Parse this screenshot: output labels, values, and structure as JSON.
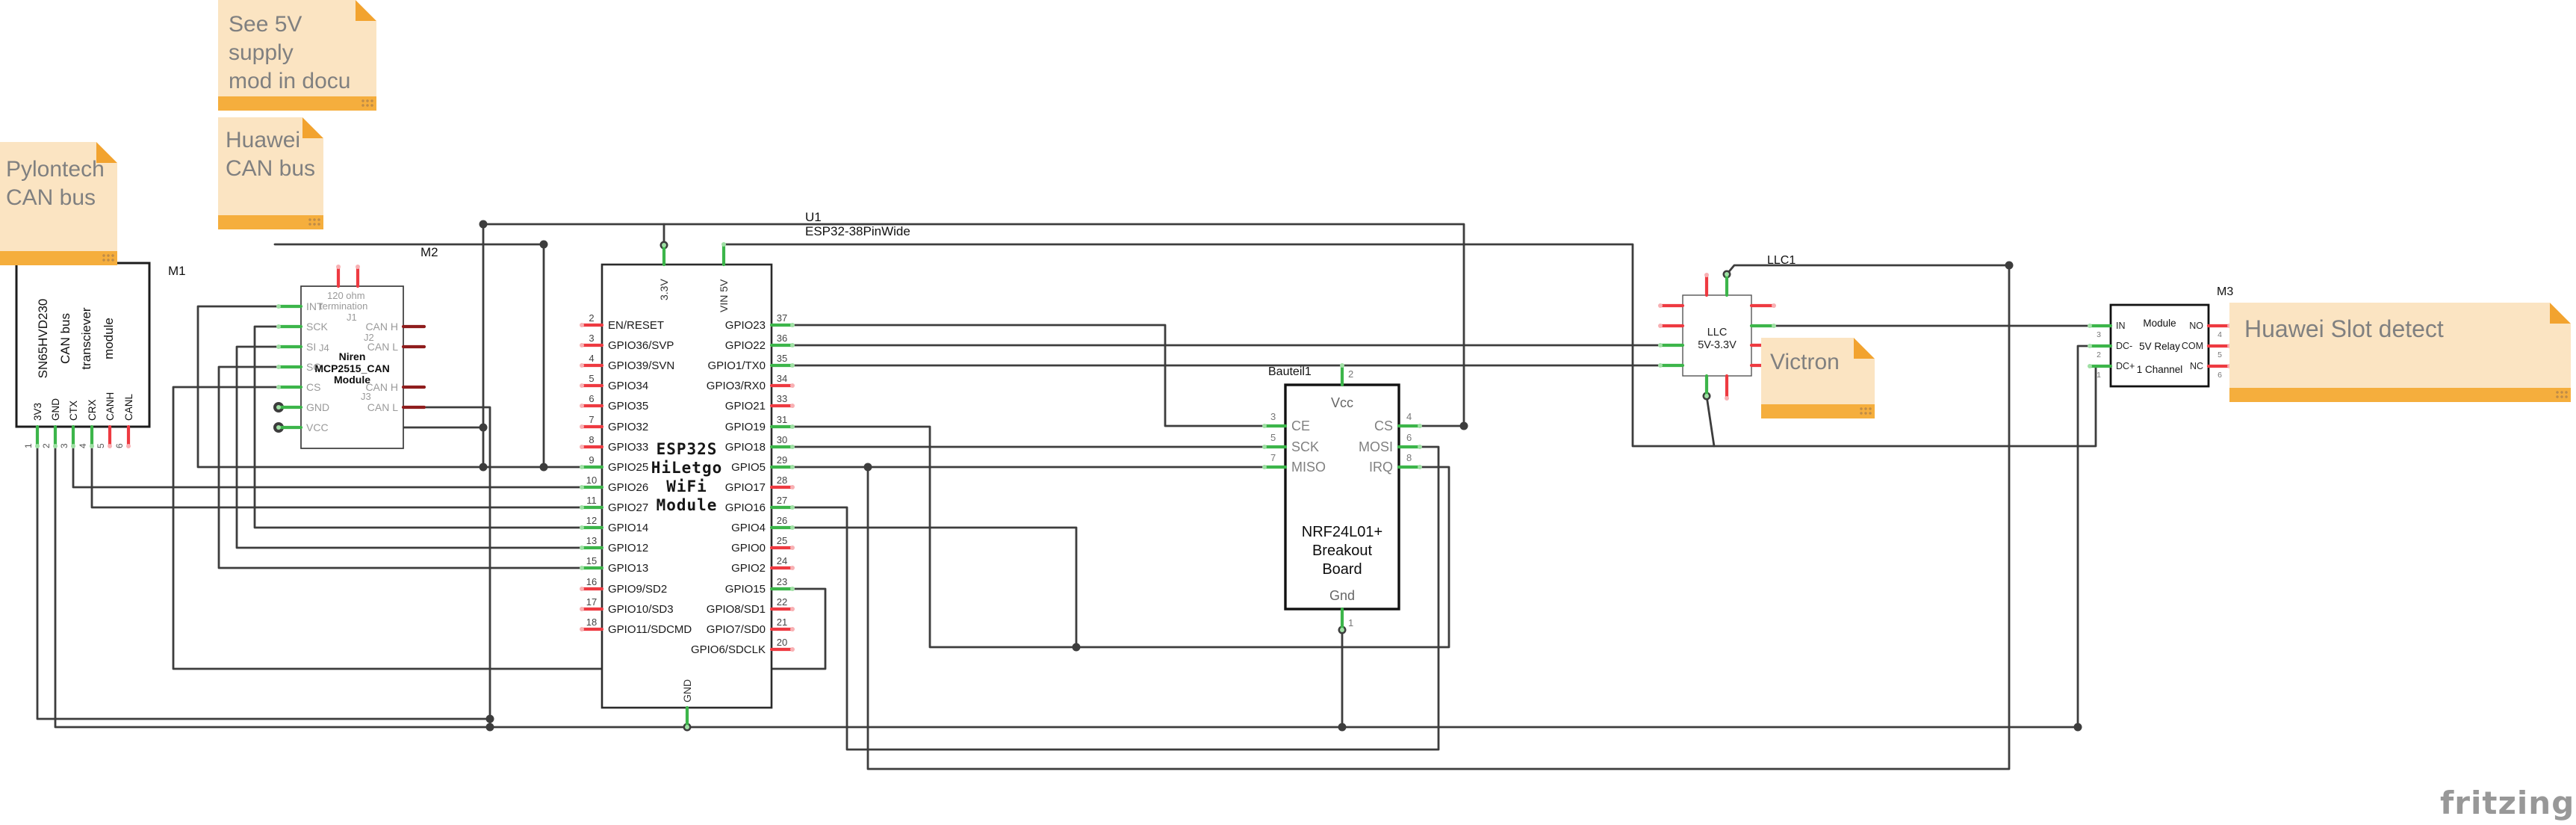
{
  "app": {
    "watermark": "fritzing"
  },
  "colors": {
    "wire": "#3d3d3d",
    "pin_green": "#3cb54a",
    "pin_green_cap": "#9fe0a4",
    "pin_red": "#ee3a41",
    "pin_red_cap": "#f8b0b3",
    "pin_darkred": "#8f1d1d",
    "note_bg": "#fbe4c2",
    "note_bar": "#f5ae3d",
    "note_text": "#808080"
  },
  "notes": {
    "supply": "See 5V supply\nmod in docu",
    "huawei_can": "Huawei\nCAN bus",
    "pylontech": "Pylontech\nCAN bus",
    "victron": "Victron",
    "slot": "Huawei Slot detect"
  },
  "components": {
    "m1": {
      "designator": "M1",
      "title_lines": [
        "SN65HVD230",
        "CAN bus",
        "transciever",
        "module"
      ],
      "pins": [
        {
          "num": "1",
          "label": "3V3",
          "color": "green"
        },
        {
          "num": "2",
          "label": "GND",
          "color": "green"
        },
        {
          "num": "3",
          "label": "CTX",
          "color": "green"
        },
        {
          "num": "4",
          "label": "CRX",
          "color": "green"
        },
        {
          "num": "5",
          "label": "CANH",
          "color": "red"
        },
        {
          "num": "6",
          "label": "CANL",
          "color": "red"
        }
      ]
    },
    "m2": {
      "designator": "M2",
      "inner": {
        "line1": "120 ohm",
        "line2": "termination",
        "j1": "J1",
        "j2": "J2",
        "j3": "J3",
        "j4": "J4",
        "name": "Niren\nMCP2515_CAN\nModule"
      },
      "left_pins": [
        {
          "label": "INT",
          "color": "green"
        },
        {
          "label": "SCK",
          "color": "green"
        },
        {
          "label": "SI",
          "color": "green"
        },
        {
          "label": "SO",
          "color": "green"
        },
        {
          "label": "CS",
          "color": "green"
        },
        {
          "label": "GND",
          "color": "green"
        },
        {
          "label": "VCC",
          "color": "green"
        }
      ],
      "right_pins": [
        {
          "label": "CAN H",
          "color": "darkred"
        },
        {
          "label": "CAN L",
          "color": "darkred"
        },
        {
          "label": "CAN H",
          "color": "darkred"
        },
        {
          "label": "CAN L",
          "color": "darkred"
        }
      ]
    },
    "u1": {
      "designator": "U1",
      "part": "ESP32-38PinWide",
      "title": "ESP32S\nHiLetgo\nWiFi\nModule",
      "top_pins": [
        {
          "label": "3.3V",
          "color": "green"
        },
        {
          "label": "VIN 5V",
          "color": "green"
        }
      ],
      "bottom_pins": [
        {
          "label": "GND",
          "color": "green"
        }
      ],
      "left_pins": [
        {
          "num": "2",
          "label": "EN/RESET",
          "color": "red"
        },
        {
          "num": "3",
          "label": "GPIO36/SVP",
          "color": "red"
        },
        {
          "num": "4",
          "label": "GPIO39/SVN",
          "color": "red"
        },
        {
          "num": "5",
          "label": "GPIO34",
          "color": "red"
        },
        {
          "num": "6",
          "label": "GPIO35",
          "color": "red"
        },
        {
          "num": "7",
          "label": "GPIO32",
          "color": "red"
        },
        {
          "num": "8",
          "label": "GPIO33",
          "color": "red"
        },
        {
          "num": "9",
          "label": "GPIO25",
          "color": "green"
        },
        {
          "num": "10",
          "label": "GPIO26",
          "color": "green"
        },
        {
          "num": "11",
          "label": "GPIO27",
          "color": "green"
        },
        {
          "num": "12",
          "label": "GPIO14",
          "color": "green"
        },
        {
          "num": "13",
          "label": "GPIO12",
          "color": "green"
        },
        {
          "num": "15",
          "label": "GPIO13",
          "color": "green"
        },
        {
          "num": "16",
          "label": "GPIO9/SD2",
          "color": "red"
        },
        {
          "num": "17",
          "label": "GPIO10/SD3",
          "color": "red"
        },
        {
          "num": "18",
          "label": "GPIO11/SDCMD",
          "color": "red"
        }
      ],
      "right_pins": [
        {
          "num": "37",
          "label": "GPIO23",
          "color": "green"
        },
        {
          "num": "36",
          "label": "GPIO22",
          "color": "green"
        },
        {
          "num": "35",
          "label": "GPIO1/TX0",
          "color": "green"
        },
        {
          "num": "34",
          "label": "GPIO3/RX0",
          "color": "red"
        },
        {
          "num": "33",
          "label": "GPIO21",
          "color": "red"
        },
        {
          "num": "31",
          "label": "GPIO19",
          "color": "green"
        },
        {
          "num": "30",
          "label": "GPIO18",
          "color": "green"
        },
        {
          "num": "29",
          "label": "GPIO5",
          "color": "green"
        },
        {
          "num": "28",
          "label": "GPIO17",
          "color": "red"
        },
        {
          "num": "27",
          "label": "GPIO16",
          "color": "green"
        },
        {
          "num": "26",
          "label": "GPIO4",
          "color": "green"
        },
        {
          "num": "25",
          "label": "GPIO0",
          "color": "red"
        },
        {
          "num": "24",
          "label": "GPIO2",
          "color": "red"
        },
        {
          "num": "23",
          "label": "GPIO15",
          "color": "green"
        },
        {
          "num": "22",
          "label": "GPIO8/SD1",
          "color": "red"
        },
        {
          "num": "21",
          "label": "GPIO7/SD0",
          "color": "red"
        },
        {
          "num": "20",
          "label": "GPIO6/SDCLK",
          "color": "red"
        }
      ]
    },
    "nrf": {
      "designator": "Bauteil1",
      "title": "NRF24L01+\nBreakout\nBoard",
      "top_pin": {
        "num": "2",
        "label": "Vcc",
        "color": "green"
      },
      "bottom_pin": {
        "num": "1",
        "label": "Gnd",
        "color": "green"
      },
      "left_pins": [
        {
          "num": "3",
          "label": "CE",
          "color": "green"
        },
        {
          "num": "5",
          "label": "SCK",
          "color": "green"
        },
        {
          "num": "7",
          "label": "MISO",
          "color": "green"
        }
      ],
      "right_pins": [
        {
          "num": "4",
          "label": "CS",
          "color": "green"
        },
        {
          "num": "6",
          "label": "MOSI",
          "color": "green"
        },
        {
          "num": "8",
          "label": "IRQ",
          "color": "green"
        }
      ]
    },
    "llc": {
      "designator": "LLC1",
      "title": "LLC\n5V-3.3V"
    },
    "m3": {
      "designator": "M3",
      "title": "Module\n5V Relay\n1 Channel",
      "left_pins": [
        {
          "num": "3",
          "label": "IN",
          "color": "green"
        },
        {
          "num": "2",
          "label": "DC-",
          "color": "green"
        },
        {
          "num": "1",
          "label": "DC+",
          "color": "green"
        }
      ],
      "right_pins": [
        {
          "num": "4",
          "label": "NO",
          "color": "red"
        },
        {
          "num": "5",
          "label": "COM",
          "color": "red"
        },
        {
          "num": "6",
          "label": "NC",
          "color": "red"
        }
      ]
    }
  }
}
